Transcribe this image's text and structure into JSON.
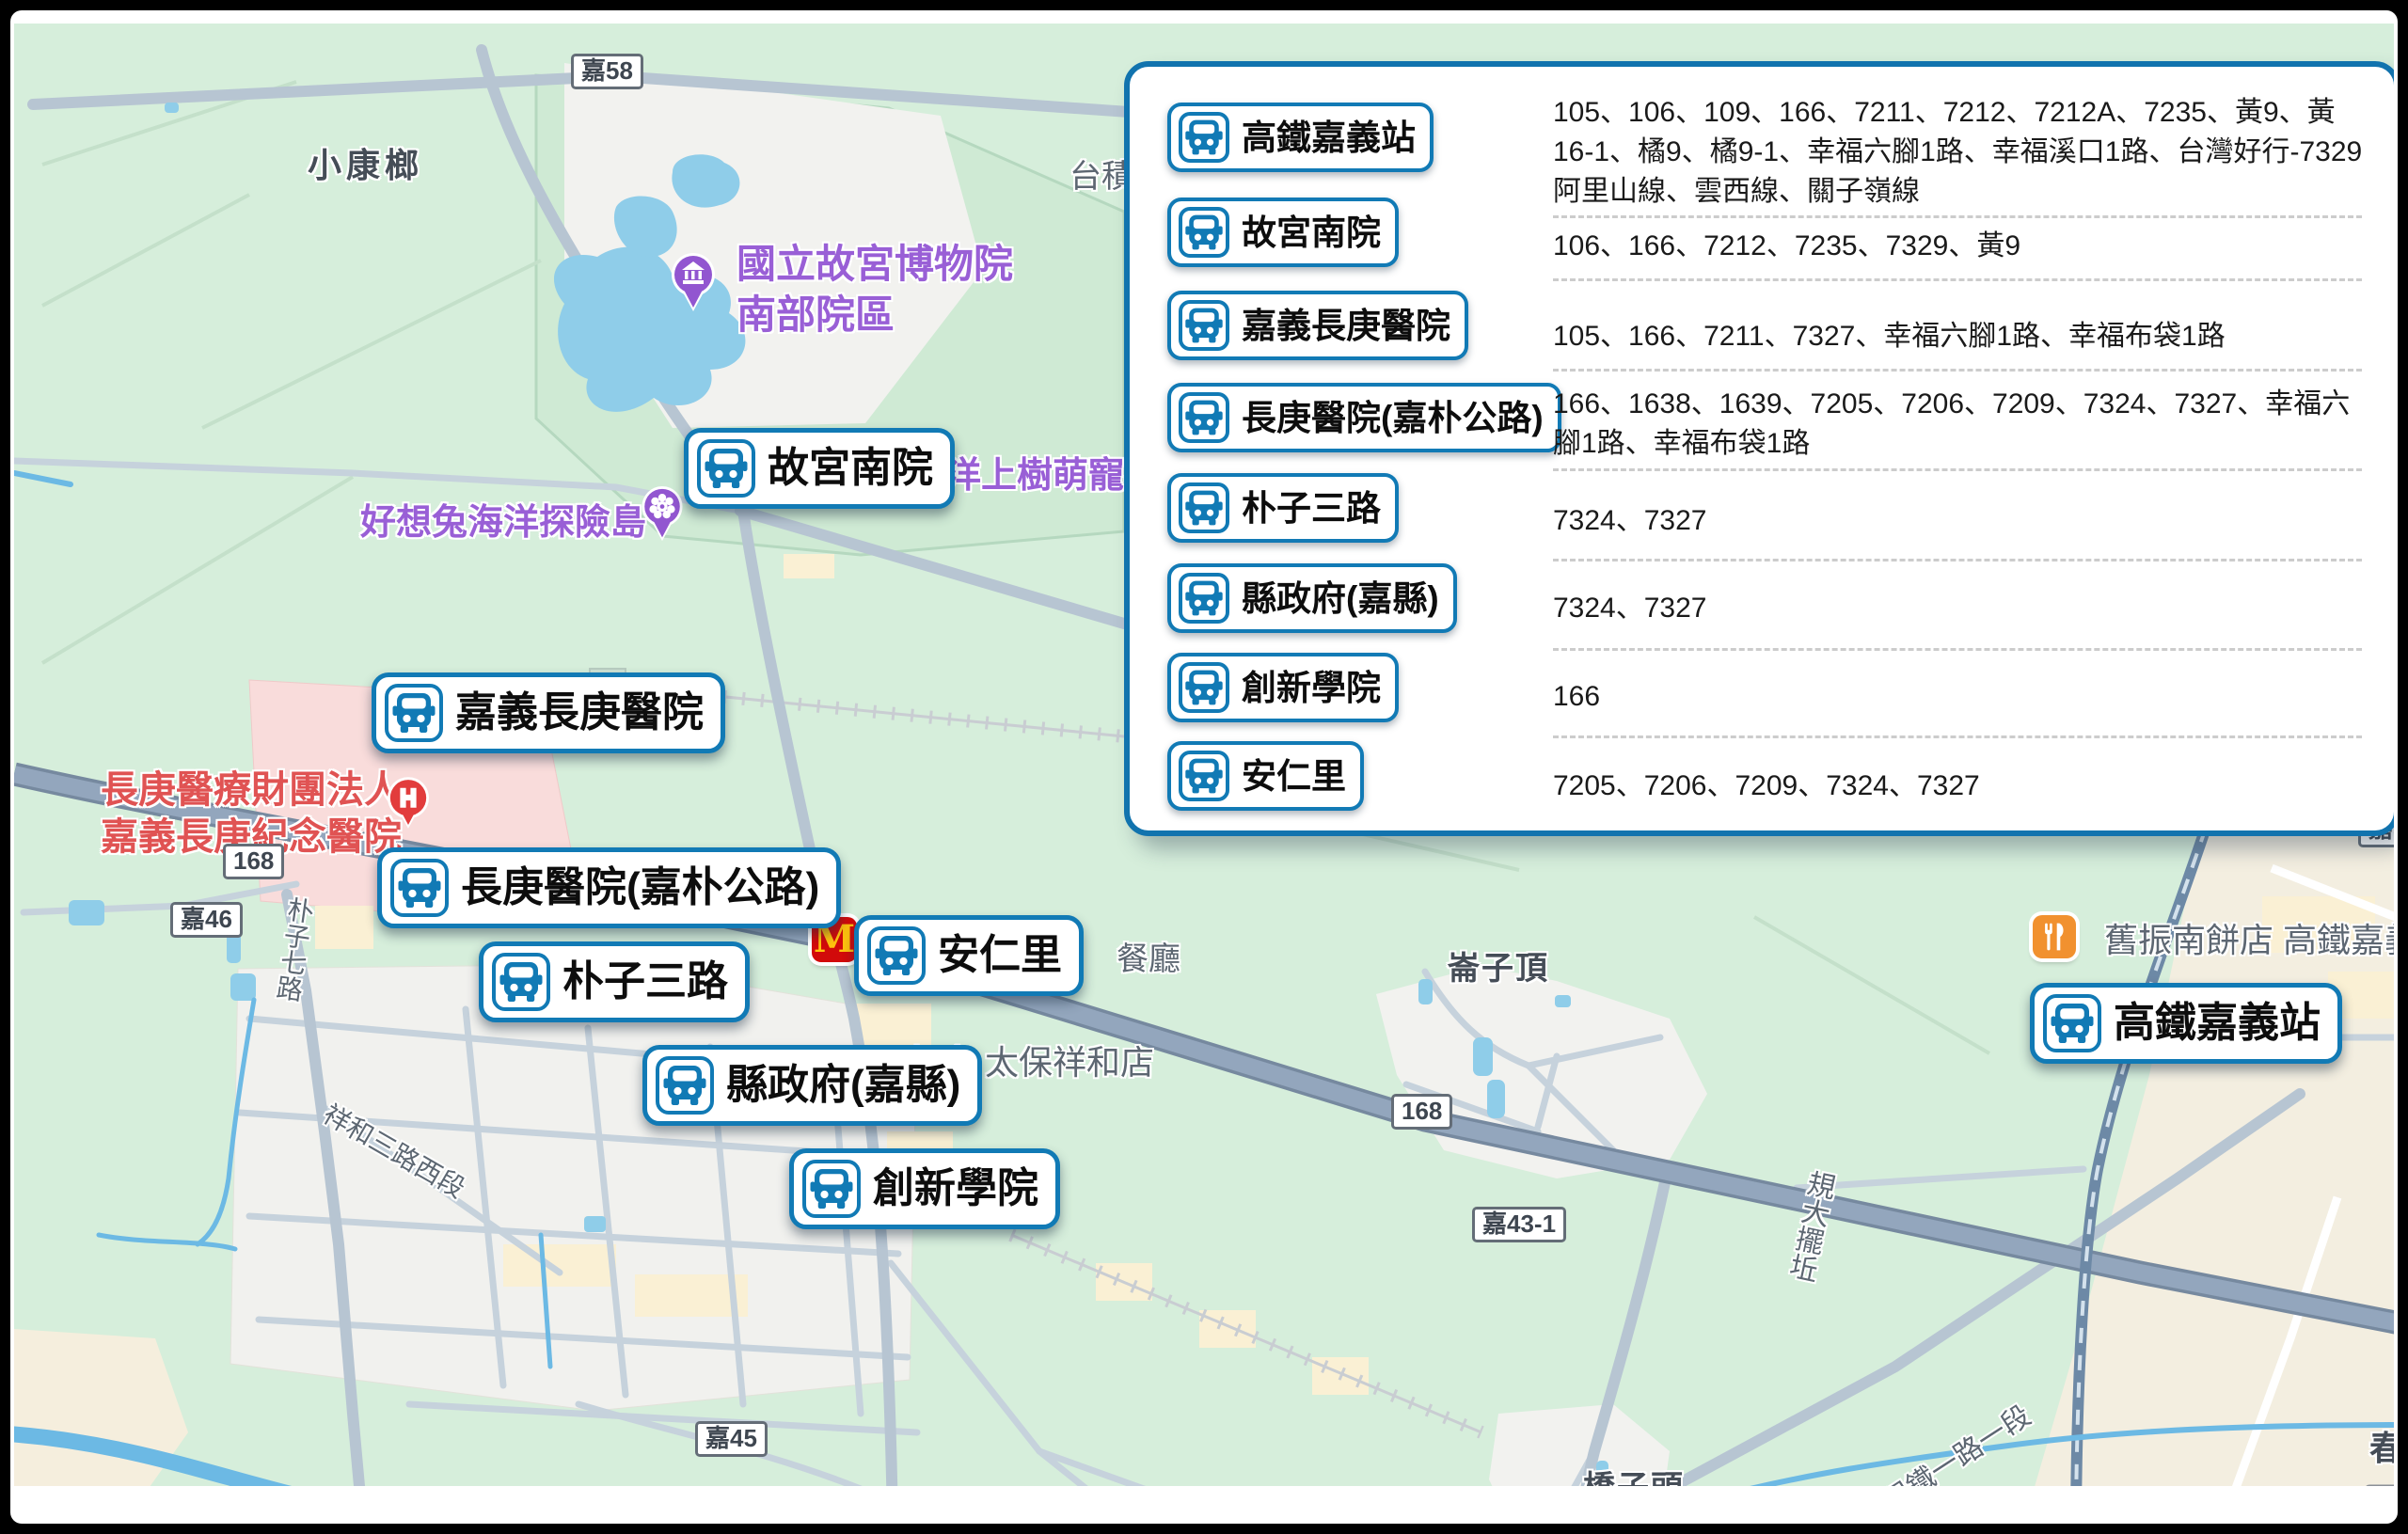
{
  "panel": {
    "rows": [
      {
        "stop": "高鐵嘉義站",
        "routes": "105、106、109、166、7211、7212、7212A、7235、黃9、黃16-1、橘9、橘9-1、幸福六腳1路、幸福溪口1路、台灣好行-7329阿里山線、雲西線、關子嶺線"
      },
      {
        "stop": "故宮南院",
        "routes": "106、166、7212、7235、7329、黃9"
      },
      {
        "stop": "嘉義長庚醫院",
        "routes": "105、166、7211、7327、幸福六腳1路、幸福布袋1路"
      },
      {
        "stop": "長庚醫院(嘉朴公路)",
        "routes": "166、1638、1639、7205、7206、7209、7324、7327、幸福六腳1路、幸福布袋1路"
      },
      {
        "stop": "朴子三路",
        "routes": "7324、7327"
      },
      {
        "stop": "縣政府(嘉縣)",
        "routes": "7324、7327"
      },
      {
        "stop": "創新學院",
        "routes": "166"
      },
      {
        "stop": "安仁里",
        "routes": "7205、7206、7209、7324、7327"
      }
    ]
  },
  "map": {
    "markers": [
      {
        "label": "故宮南院"
      },
      {
        "label": "嘉義長庚醫院"
      },
      {
        "label": "長庚醫院(嘉朴公路)"
      },
      {
        "label": "朴子三路"
      },
      {
        "label": "安仁里"
      },
      {
        "label": "縣政府(嘉縣)"
      },
      {
        "label": "創新學院"
      },
      {
        "label": "高鐵嘉義站"
      }
    ],
    "poi": {
      "museum_title": "國立故宮博物院",
      "museum_subtitle": "南部院區",
      "rabbit_island": "好想兔海洋探險島",
      "pet_park_partial": "洋上樹萌寵樂園",
      "hospital_line1": "長庚醫療財團法人",
      "hospital_line2": "嘉義長庚紀念醫院",
      "bakery": "舊振南餅店 高鐵嘉義",
      "supermarket": "超市 太保祥和店",
      "restaurant": "餐廳",
      "tsmc_partial": "台積"
    },
    "localities": {
      "xiaokanglang": "小康榔",
      "lunziding": "崙子頂",
      "qiaozitou": "橋子頭",
      "east_partial": "東",
      "spring_partial": "春"
    },
    "streets": {
      "puzi7": "朴子七路",
      "xianghe3": "祥和三路西段",
      "baotie1": "保鐵一路一段",
      "drain": "規大擺坵"
    },
    "shields": {
      "jia58": "嘉58",
      "r168a": "168",
      "jia46": "嘉46",
      "r168b": "168",
      "jia43": "嘉43-1",
      "jia45": "嘉45",
      "jia5": "嘉5"
    }
  },
  "colors": {
    "marker_border": "#117ab5",
    "bus_icon": "#117ab5",
    "panel_border": "#1173ae",
    "route_text": "#1a1a1a",
    "poi_purple": "#995fd6",
    "hospital_red": "#e05353",
    "poi_orange": "#f1912f",
    "mcdonalds_red": "#d20a0a",
    "mcdonalds_yellow": "#ffc20e",
    "map_green": "#d6eedb",
    "water_blue": "#8fcde9",
    "road_major": "#93a6bd"
  }
}
